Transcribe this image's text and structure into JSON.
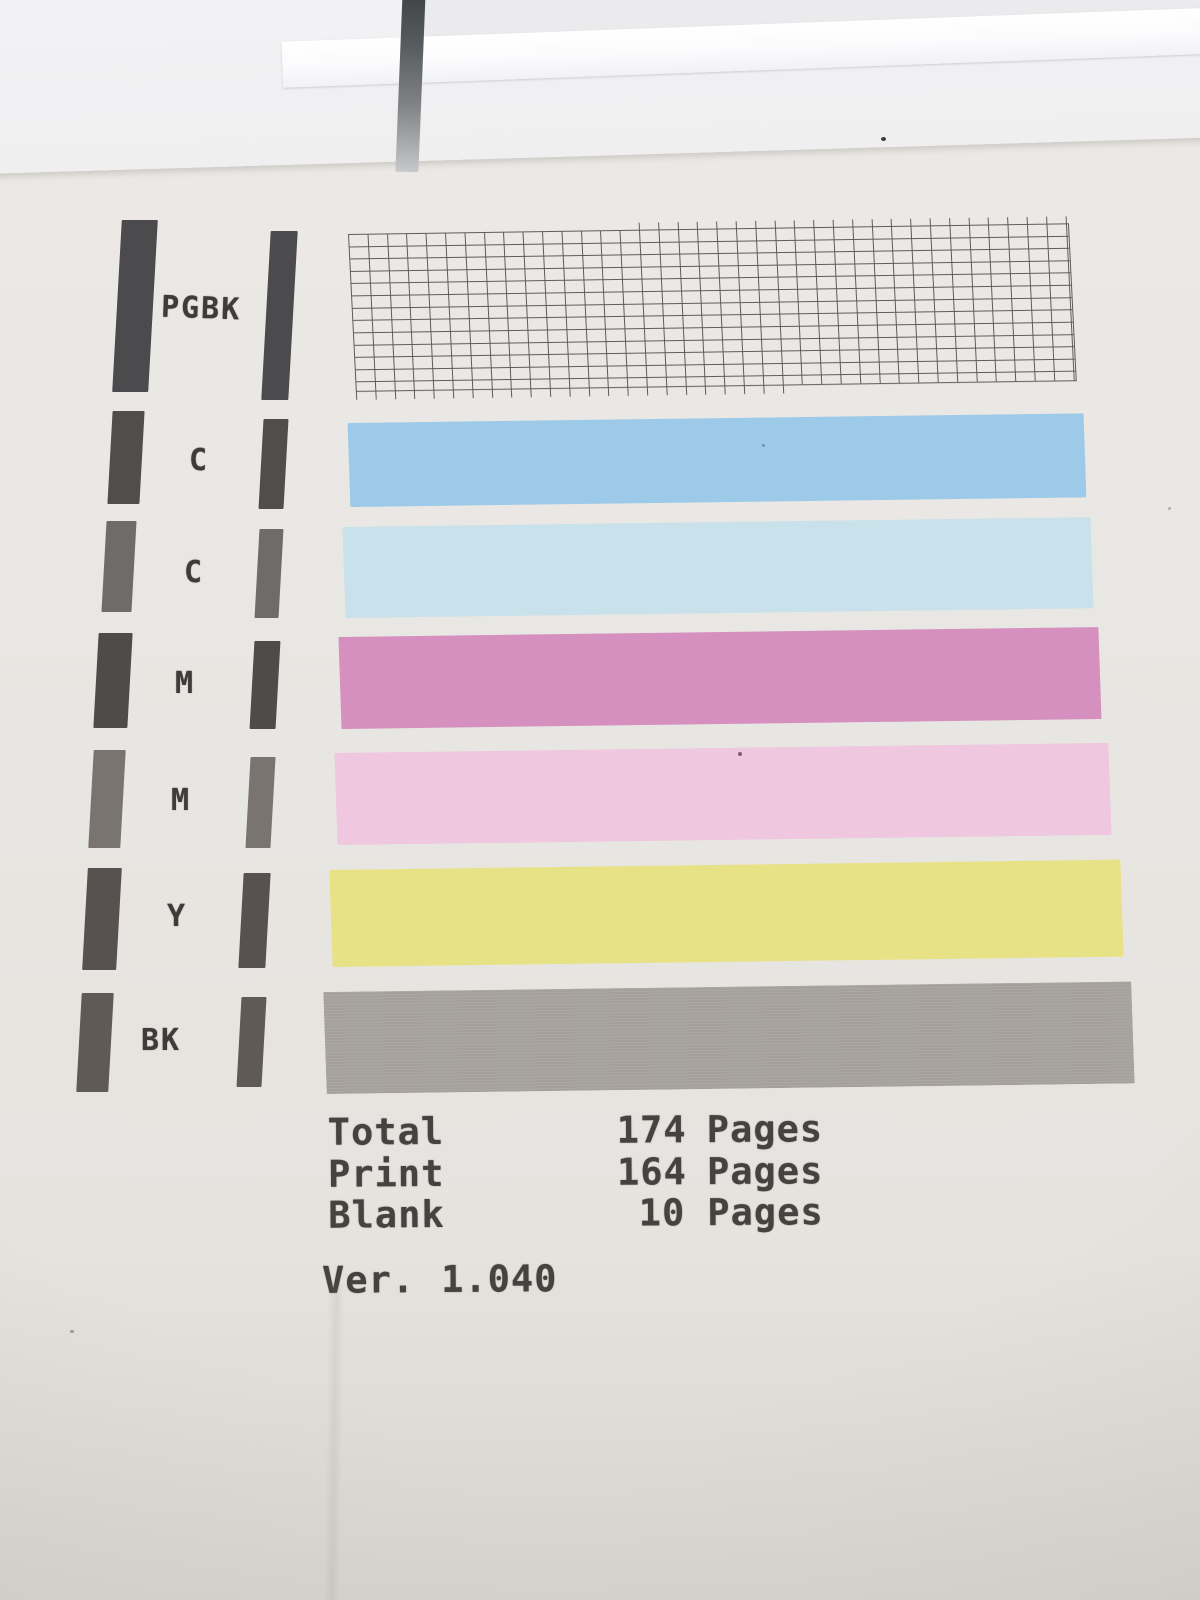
{
  "rows": [
    {
      "label": "PGBK",
      "bar_color": "#4b4a4c",
      "pattern": "nozzle-grid"
    },
    {
      "label": "C",
      "bar_color": "#504d4c",
      "stripe_color": "#9ccae8"
    },
    {
      "label": "C",
      "bar_color": "#6e6b68",
      "stripe_color": "#c8e1eb"
    },
    {
      "label": "M",
      "bar_color": "#4f4b4a",
      "stripe_color": "#d590c0"
    },
    {
      "label": "M",
      "bar_color": "#7a7470",
      "stripe_color": "#efc7de"
    },
    {
      "label": "Y",
      "bar_color": "#575250",
      "stripe_color": "#e7e285"
    },
    {
      "label": "BK",
      "bar_color": "#5f5a56",
      "stripe_color": "#a8a39f"
    }
  ],
  "counters": [
    {
      "label": "Total",
      "value": "174",
      "unit": "Pages"
    },
    {
      "label": "Print",
      "value": "164",
      "unit": "Pages"
    },
    {
      "label": "Blank",
      "value": "10",
      "unit": "Pages"
    }
  ],
  "version": {
    "label": "Ver.",
    "value": "1.040"
  },
  "colors": {
    "paper": "#e9e7e3",
    "paper_top_edge": "#f2f2f4",
    "grid_line": "#4a4947",
    "text": "#45423f",
    "slot_shadow": "#4a4e52"
  }
}
